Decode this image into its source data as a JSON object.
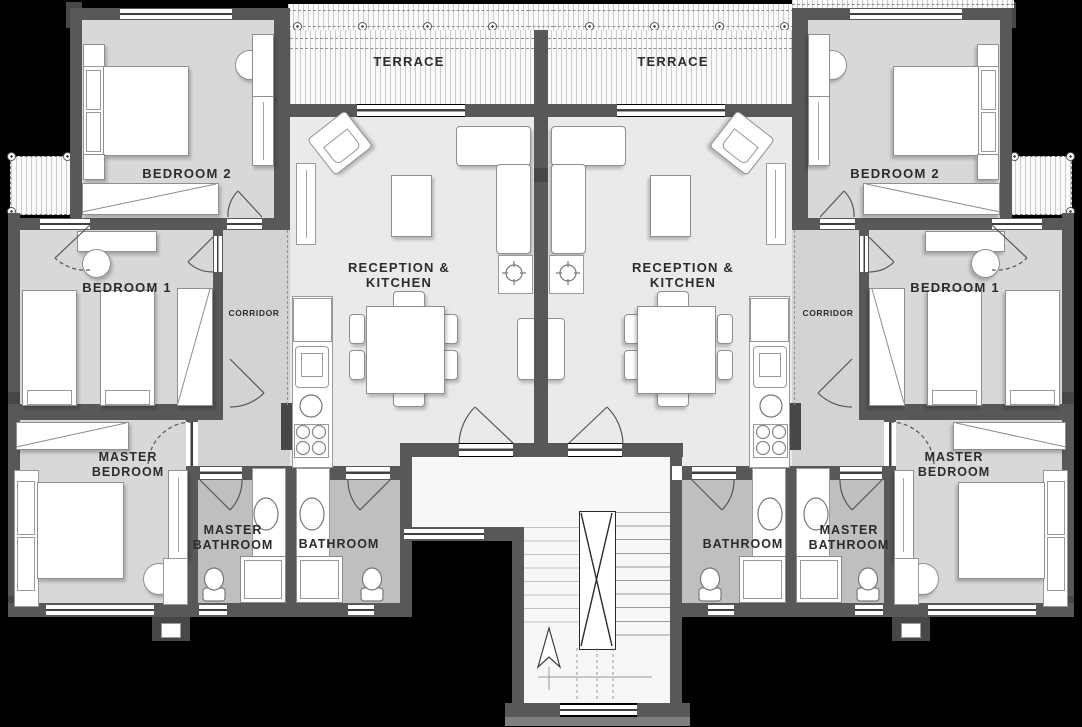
{
  "labels": {
    "terrace": "TERRACE",
    "bedroom2": "BEDROOM 2",
    "bedroom1": "BEDROOM 1",
    "corridor": "CORRIDOR",
    "reception_line1": "RECEPTION &",
    "reception_line2": "KITCHEN",
    "master_line1": "MASTER",
    "master_bedroom_line2": "BEDROOM",
    "master_bathroom_line2": "BATHROOM",
    "bathroom": "BATHROOM"
  },
  "colors": {
    "background": "#000000",
    "wall": "#58585a",
    "wall_dark": "#47474a",
    "floor_bedroom": "#d8d8d8",
    "floor_reception": "#eaeaea",
    "floor_corridor": "#d3d3d3",
    "floor_bathroom": "#bfbfbf",
    "floor_light": "#f7f7f7",
    "furniture": "#ffffff",
    "label_text": "#2c2c2c"
  }
}
